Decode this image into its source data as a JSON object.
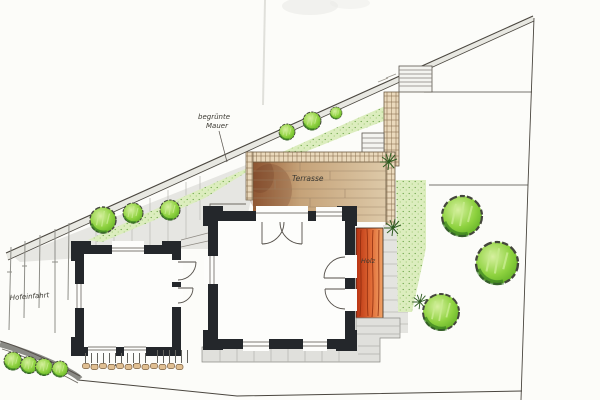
{
  "labels": {
    "greened_wall_line1": "begrünte",
    "greened_wall_line2": "Mauer",
    "terrace": "Terrasse",
    "wood": "Holz",
    "courtyard_entrance": "Hofeinfahrt"
  },
  "palette": {
    "paper": "#fcfcf9",
    "ink": "#55504a",
    "wall_black": "#24272b",
    "foliage_green": "#7fc93c",
    "foliage_light": "#dcedbe",
    "terrace_tan": "#d8c3a2",
    "terrace_brown": "#8a5230",
    "wood_orange": "#d4512a",
    "paving_gray": "#e3e3df",
    "brick_tan": "#ead9bc"
  }
}
